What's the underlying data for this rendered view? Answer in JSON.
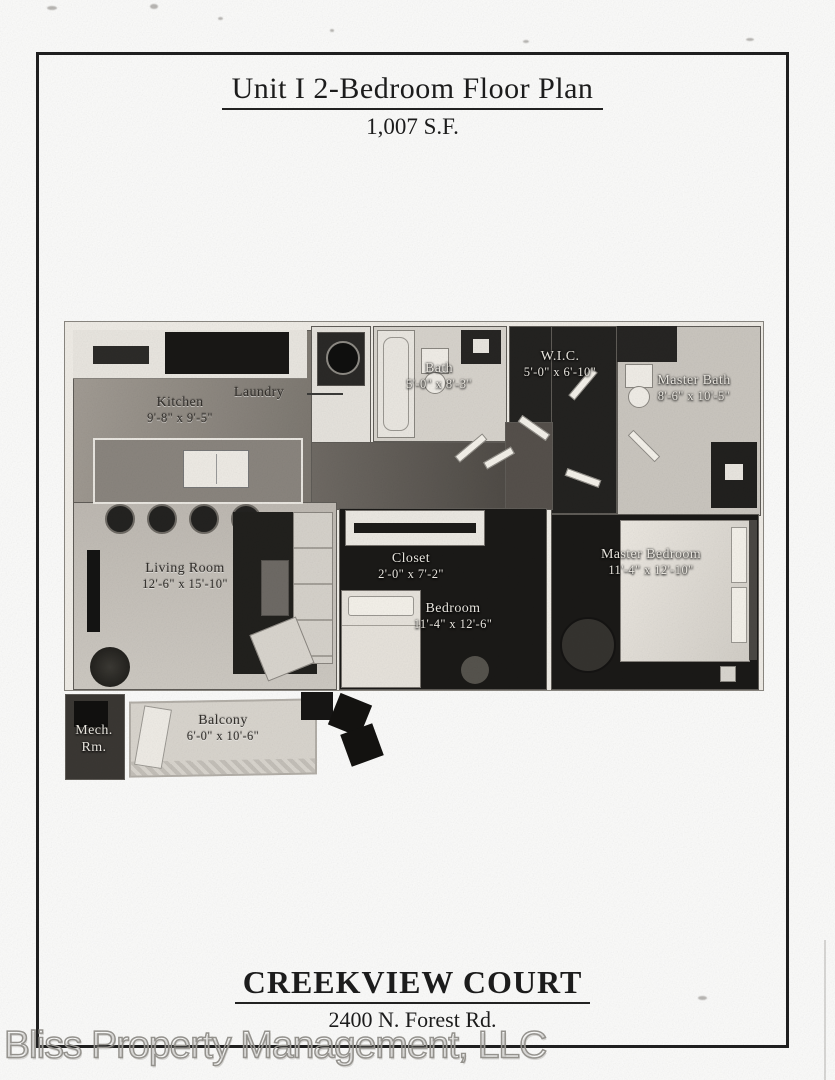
{
  "page": {
    "title": "Unit I 2-Bedroom Floor Plan",
    "area": "1,007 S.F.",
    "property_name": "CREEKVIEW COURT",
    "address": "2400 N. Forest Rd.",
    "watermark": "Bliss Property Management, LLC"
  },
  "colors": {
    "page_border": "#1f1f1f",
    "wall": "#efece6",
    "wood_floor": "#8f8a83",
    "light_floor": "#c7c3bc",
    "dark_carpet": "#1a1917"
  },
  "rooms": {
    "kitchen": {
      "name": "Kitchen",
      "dims": "9'-8\" x 9'-5\""
    },
    "laundry": {
      "name": "Laundry"
    },
    "bath": {
      "name": "Bath",
      "dims": "5'-0\" x 8'-3\""
    },
    "wic": {
      "name": "W.I.C.",
      "dims": "5'-0\" x 6'-10\""
    },
    "master_bath": {
      "name": "Master Bath",
      "dims": "8'-6\" x 10'-5\""
    },
    "living_room": {
      "name": "Living Room",
      "dims": "12'-6\" x 15'-10\""
    },
    "closet": {
      "name": "Closet",
      "dims": "2'-0\" x 7'-2\""
    },
    "bedroom": {
      "name": "Bedroom",
      "dims": "11'-4\" x 12'-6\""
    },
    "master_bedroom": {
      "name": "Master Bedroom",
      "dims": "11'-4\" x 12'-10\""
    },
    "mech": {
      "name": "Mech. Rm."
    },
    "balcony": {
      "name": "Balcony",
      "dims": "6'-0\" x 10'-6\""
    }
  }
}
